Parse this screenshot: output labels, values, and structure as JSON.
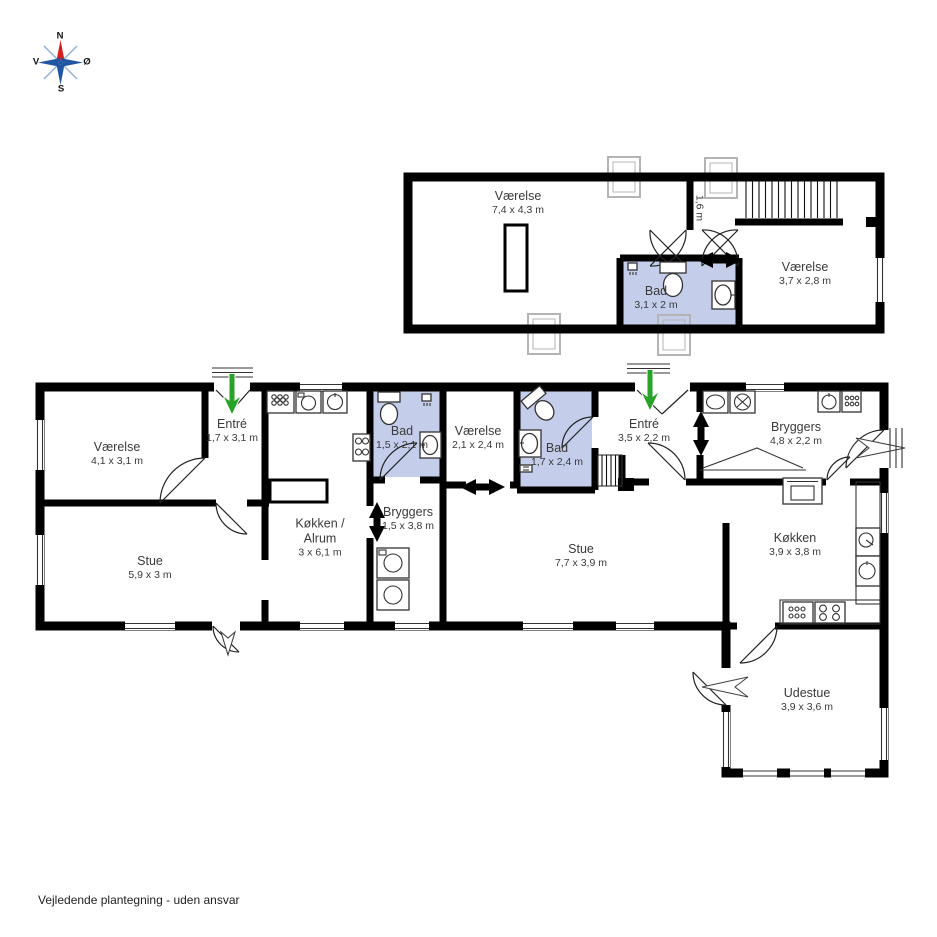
{
  "page": {
    "footer": "Vejledende plantegning - uden ansvar"
  },
  "colors": {
    "wall": "#000000",
    "bathroom_fill": "#c4cdea",
    "skylight_gray": "#b4b4b4",
    "entrance_arrow_green": "#27a327",
    "compass_blue": "#2055a3",
    "compass_red": "#d42020",
    "label_text": "#3a3a3a"
  },
  "compass": {
    "north": "N",
    "south": "S",
    "east": "Ø",
    "west": "V"
  },
  "upper_floor": {
    "hall_width": "1,6 m",
    "rooms": [
      {
        "id": "vaerelse-stor",
        "label": "Værelse",
        "dims": "7,4 x 4,3 m"
      },
      {
        "id": "bad",
        "label": "Bad",
        "dims": "3,1 x 2 m"
      },
      {
        "id": "vaerelse-lille",
        "label": "Værelse",
        "dims": "3,7 x 2,8 m"
      }
    ]
  },
  "ground_floor": {
    "rooms": [
      {
        "id": "vaerelse-vest",
        "label": "Værelse",
        "dims": "4,1 x 3,1 m"
      },
      {
        "id": "entre-vest",
        "label": "Entré",
        "dims": "1,7 x 3,1 m"
      },
      {
        "id": "stue-vest",
        "label": "Stue",
        "dims": "5,9 x 3 m"
      },
      {
        "id": "koekken-alrum",
        "label": "Køkken /",
        "label2": "Alrum",
        "dims": "3 x 6,1 m"
      },
      {
        "id": "bad-vest",
        "label": "Bad",
        "dims": "1,5 x 2,1 m"
      },
      {
        "id": "bryggers-vest",
        "label": "Bryggers",
        "dims": "1,5 x 3,8 m"
      },
      {
        "id": "vaerelse-midt",
        "label": "Værelse",
        "dims": "2,1 x 2,4 m"
      },
      {
        "id": "bad-oest",
        "label": "Bad",
        "dims": "1,7 x 2,4 m"
      },
      {
        "id": "entre-oest",
        "label": "Entré",
        "dims": "3,5 x 2,2 m"
      },
      {
        "id": "stue-oest",
        "label": "Stue",
        "dims": "7,7 x 3,9 m"
      },
      {
        "id": "bryggers-oest",
        "label": "Bryggers",
        "dims": "4,8 x 2,2 m"
      },
      {
        "id": "koekken-oest",
        "label": "Køkken",
        "dims": "3,9 x 3,8 m"
      },
      {
        "id": "udestue",
        "label": "Udestue",
        "dims": "3,9 x 3,6 m"
      }
    ]
  }
}
